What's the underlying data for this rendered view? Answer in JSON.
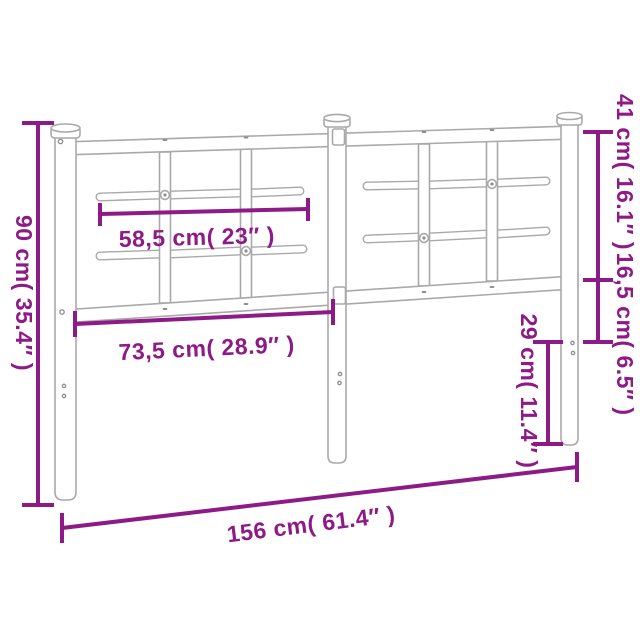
{
  "diagram": {
    "colors": {
      "accent": "#8e1a87",
      "frame": "#a9a9a9",
      "background": "#ffffff"
    },
    "labels": {
      "height_total": "90 cm( 35.4″ )",
      "upper_section_height": "41 cm( 16.1″ )",
      "mid_section_height": "16,5 cm( 6.5″ )",
      "inner_bar_width": "58,5 cm( 23″ )",
      "panel_width": "73,5 cm( 28.9″ )",
      "leg_height": "29 cm( 11.4″ )",
      "total_width": "156 cm( 61.4″ )"
    }
  }
}
